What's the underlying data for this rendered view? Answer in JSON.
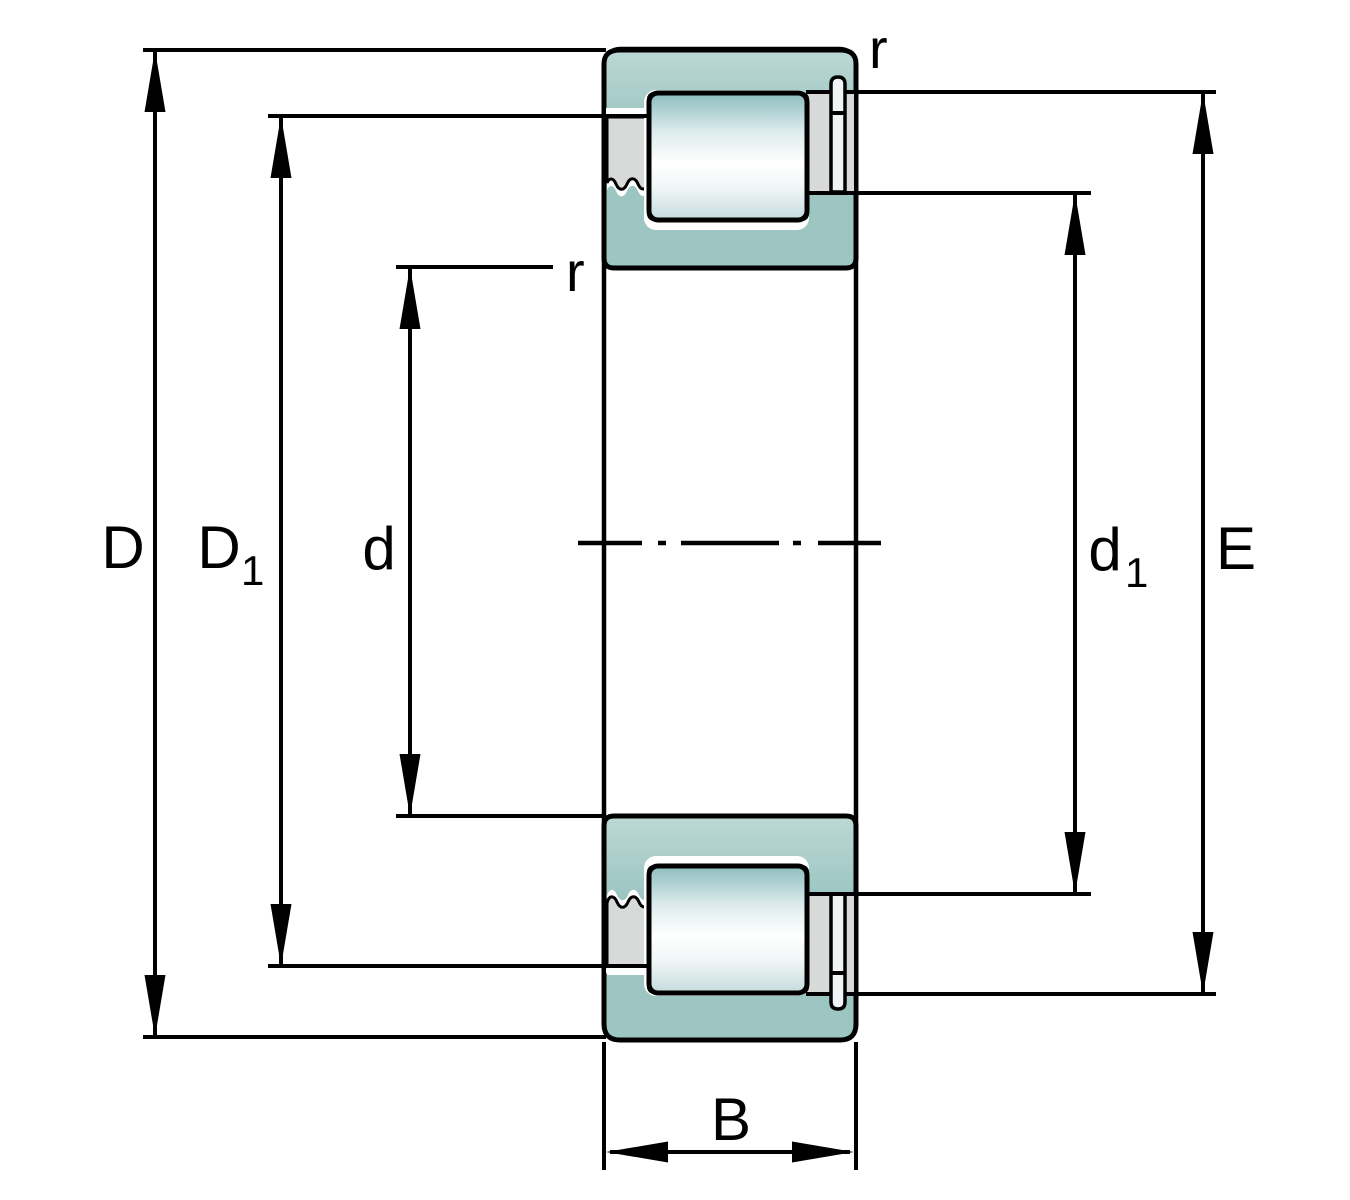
{
  "figure": {
    "description": "Cross-section dimension drawing of a single-row cylindrical roller bearing with snap ring",
    "background": "#ffffff"
  },
  "colors": {
    "outline": "#000000",
    "outer_ring_light": "#bcd8d5",
    "outer_ring": "#9dc6c2",
    "roller_dark": "#8cbcbf",
    "roller_mid": "#dcebec",
    "roller_light": "#ffffff",
    "roller_sheen": "#f0f6f6",
    "roller_bottom": "#c5dbde",
    "steel_gray": "#d8dada",
    "snap_ring": "#f0f4f4"
  },
  "labels": {
    "D": {
      "main": "D",
      "sub": ""
    },
    "D1": {
      "main": "D",
      "sub": "1"
    },
    "d": {
      "main": "d",
      "sub": ""
    },
    "d1": {
      "main": "d",
      "sub": "1"
    },
    "E": {
      "main": "E",
      "sub": ""
    },
    "B": {
      "main": "B",
      "sub": ""
    },
    "r_outer": "r",
    "r_inner": "r"
  }
}
